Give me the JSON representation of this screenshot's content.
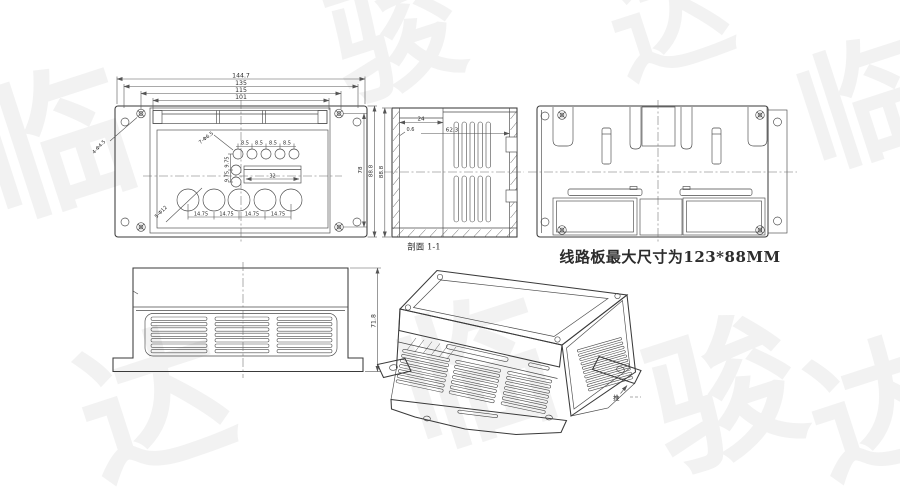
{
  "note": {
    "pcb_max_size": "线路板最大尺寸为123*88MM"
  },
  "labels": {
    "section": "剖面 1-1",
    "push": "推"
  },
  "front_view": {
    "dim_chain": [
      "144.7",
      "135",
      "115",
      "101"
    ],
    "top_pitch": [
      "8.5",
      "8.5",
      "8.5",
      "8.5"
    ],
    "bottom_pitch": [
      "14.75",
      "14.75",
      "14.75",
      "14.75"
    ],
    "left_pitch": [
      "9.75",
      "9.75"
    ],
    "slot_width": "32",
    "height_inner": "78",
    "height_outer": "88.8",
    "corner_holes": "4-Φ4.5",
    "small_holes": "7-Φ6.5",
    "large_holes": "5-Φ12"
  },
  "section_view": {
    "top": "24",
    "lip": "0.6",
    "depth": "62.3",
    "height": "88.8"
  },
  "side_view": {
    "height": "71.8"
  },
  "watermark": {
    "glyphs": [
      "临",
      "达",
      "骏",
      "临",
      "达",
      "骏",
      "临",
      "达"
    ]
  }
}
